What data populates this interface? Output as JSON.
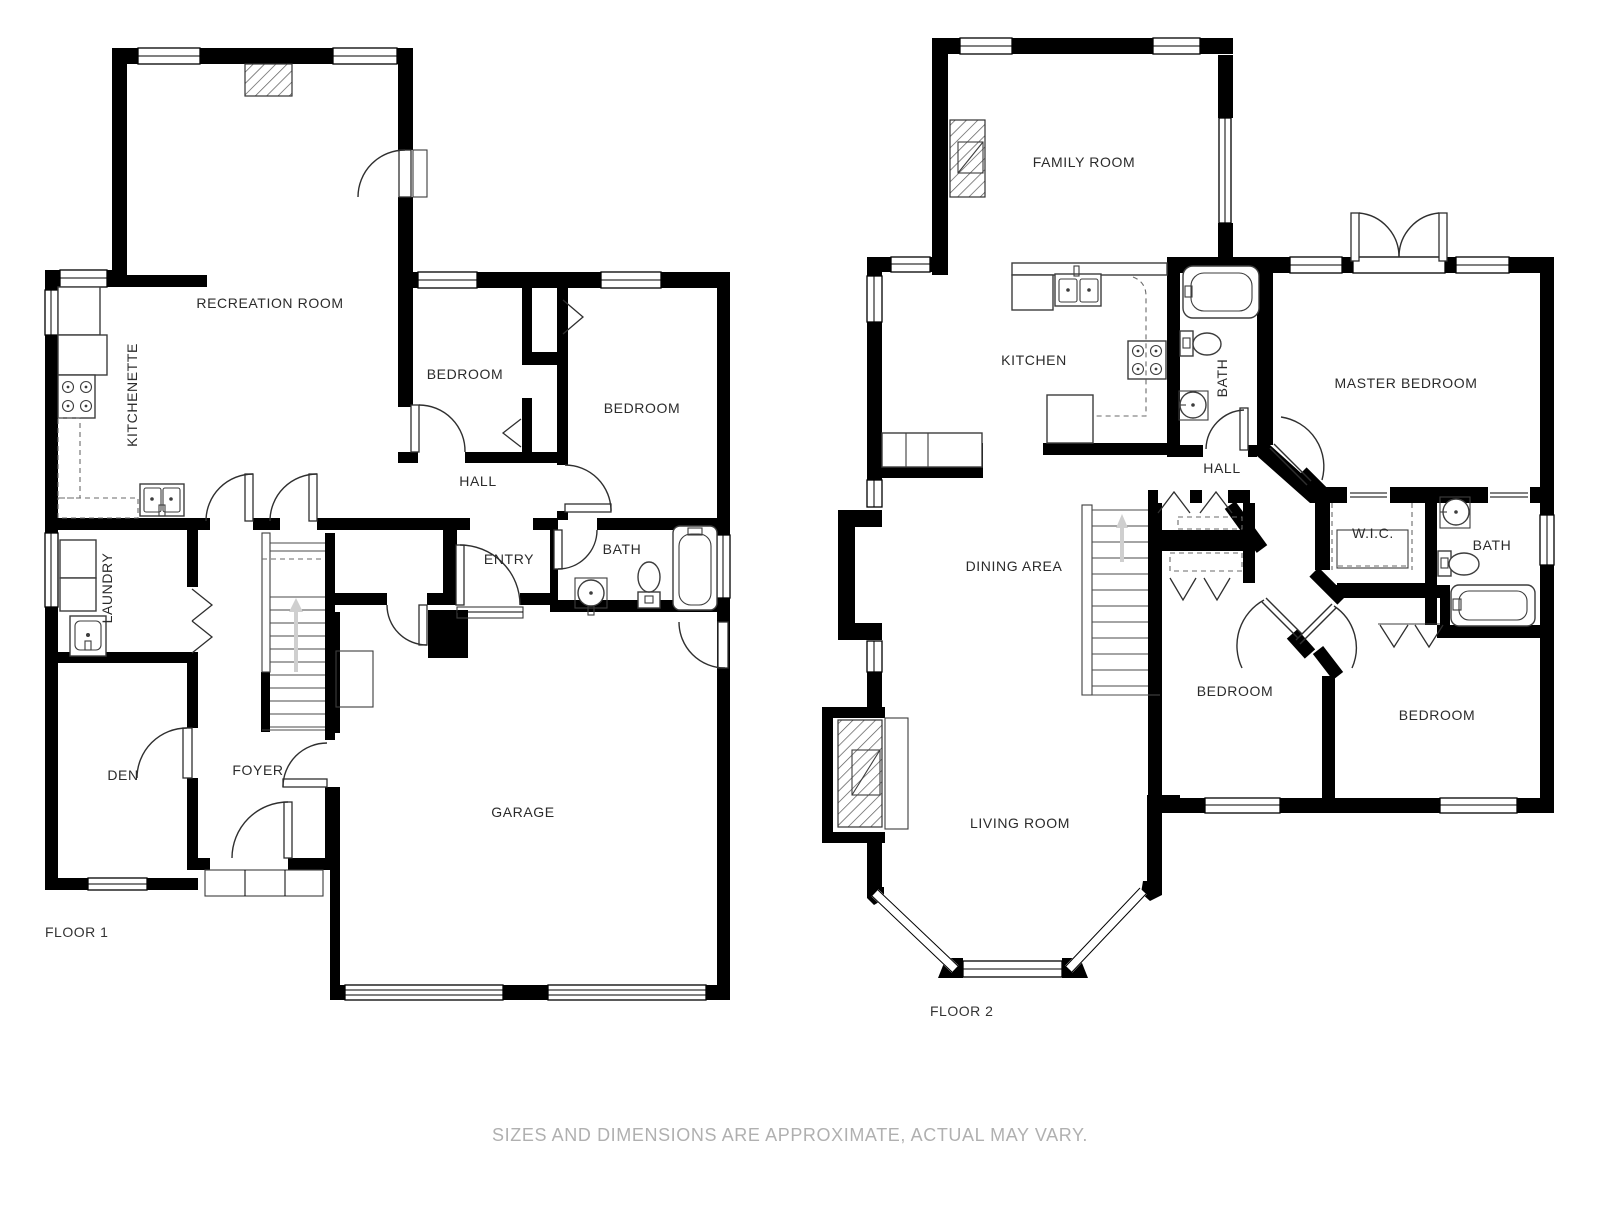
{
  "page": {
    "disclaimer": "SIZES AND DIMENSIONS ARE APPROXIMATE, ACTUAL MAY VARY.",
    "background_color": "#ffffff",
    "wall_color": "#000000",
    "label_color": "#2b2b2b",
    "disclaimer_color": "#b0b0b0"
  },
  "floor1": {
    "title": "FLOOR 1",
    "rooms": {
      "recreation": "RECREATION ROOM",
      "kitchenette": "KITCHENETTE",
      "bedroom_small": "BEDROOM",
      "bedroom_large": "BEDROOM",
      "hall": "HALL",
      "bath": "BATH",
      "entry": "ENTRY",
      "laundry": "LAUNDRY",
      "den": "DEN",
      "foyer": "FOYER",
      "garage": "GARAGE"
    }
  },
  "floor2": {
    "title": "FLOOR 2",
    "rooms": {
      "family_room": "FAMILY ROOM",
      "kitchen": "KITCHEN",
      "bath_upper": "BATH",
      "master_bedroom": "MASTER BEDROOM",
      "hall": "HALL",
      "dining_area": "DINING AREA",
      "wic": "W.I.C.",
      "bath_lower": "BATH",
      "bedroom_middle": "BEDROOM",
      "bedroom_right": "BEDROOM",
      "living_room": "LIVING ROOM"
    }
  }
}
